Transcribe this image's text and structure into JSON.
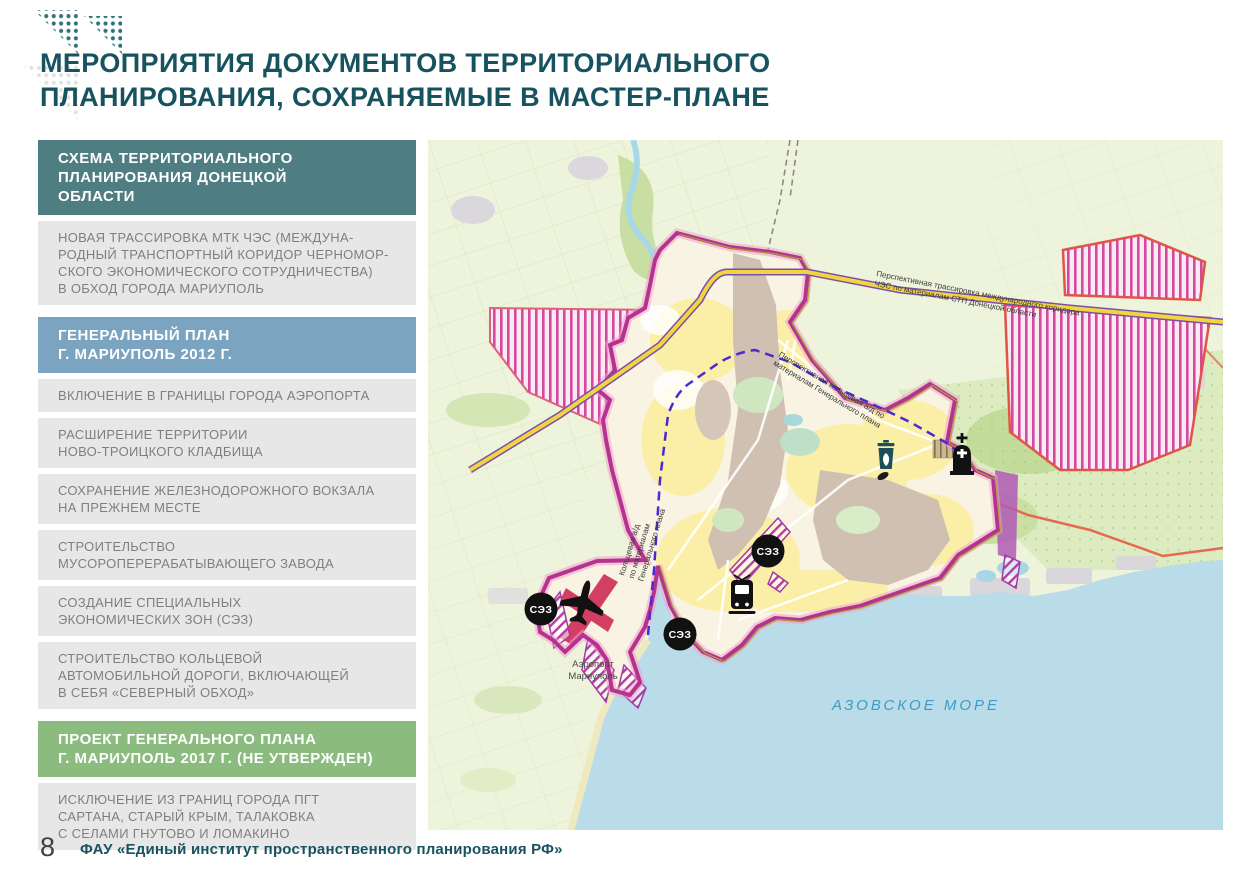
{
  "page": {
    "title": "МЕРОПРИЯТИЯ ДОКУМЕНТОВ ТЕРРИТОРИАЛЬНОГО\nПЛАНИРОВАНИЯ, СОХРАНЯЕМЫЕ В МАСТЕР-ПЛАНЕ"
  },
  "sidebar": {
    "blocks": [
      {
        "type": "header",
        "text": "СХЕМА ТЕРРИТОРИАЛЬНОГО\nПЛАНИРОВАНИЯ ДОНЕЦКОЙ\nОБЛАСТИ"
      },
      {
        "type": "item",
        "text": "НОВАЯ ТРАССИРОВКА МТК ЧЭС (МЕЖДУНА-\nРОДНЫЙ ТРАНСПОРТНЫЙ КОРИДОР ЧЕРНОМОР-\nСКОГО ЭКОНОМИЧЕСКОГО СОТРУДНИЧЕСТВА)\nВ ОБХОД ГОРОДА МАРИУПОЛЬ"
      },
      {
        "type": "header",
        "text": "ГЕНЕРАЛЬНЫЙ ПЛАН\nГ. МАРИУПОЛЬ 2012 Г."
      },
      {
        "type": "item",
        "text": "ВКЛЮЧЕНИЕ В ГРАНИЦЫ ГОРОДА АЭРОПОРТА"
      },
      {
        "type": "item",
        "text": "РАСШИРЕНИЕ ТЕРРИТОРИИ\nНОВО-ТРОИЦКОГО КЛАДБИЩА"
      },
      {
        "type": "item",
        "text": "СОХРАНЕНИЕ ЖЕЛЕЗНОДОРОЖНОГО ВОКЗАЛА\nНА ПРЕЖНЕМ МЕСТЕ"
      },
      {
        "type": "item",
        "text": "СТРОИТЕЛЬСТВО\nМУСОРОПЕРЕРАБАТЫВАЮЩЕГО ЗАВОДА"
      },
      {
        "type": "item",
        "text": "СОЗДАНИЕ СПЕЦИАЛЬНЫХ\nЭКОНОМИЧЕСКИХ ЗОН (СЭЗ)"
      },
      {
        "type": "item",
        "text": "СТРОИТЕЛЬСТВО КОЛЬЦЕВОЙ\nАВТОМОБИЛЬНОЙ ДОРОГИ, ВКЛЮЧАЮЩЕЙ\nВ СЕБЯ «СЕВЕРНЫЙ ОБХОД»"
      },
      {
        "type": "header",
        "text": "ПРОЕКТ ГЕНЕРАЛЬНОГО ПЛАНА\nГ. МАРИУПОЛЬ 2017 Г. (НЕ УТВЕРЖДЕН)"
      },
      {
        "type": "item",
        "text": "ИСКЛЮЧЕНИЕ ИЗ ГРАНИЦ ГОРОДА ПГТ\nСАРТАНА, СТАРЫЙ КРЫМ, ТАЛАКОВКА\nС СЕЛАМИ ГНУТОВО И ЛОМАКИНО"
      }
    ]
  },
  "map": {
    "road_label_line1": "Перспективная трассировка международного коридора",
    "road_label_line2": "ЧЭС по материалам СТП Донецкой области",
    "ring_ne_label_line1": "Перспективная кольцевая а/д по",
    "ring_ne_label_line2": "материалам Генерального плана",
    "ring_w_label_line1": "Кольцевая а/д",
    "ring_w_label_line2": "по материалам",
    "ring_w_label_line3": "Генерального плана",
    "airport_label_line1": "Аэропорт",
    "airport_label_line2": "Мариуполь",
    "sea_label": "АЗОВСКОЕ МОРЕ",
    "sez_badge_label": "СЭЗ",
    "icons": [
      "sez-badge",
      "airplane-icon",
      "tram-icon",
      "church-icon",
      "waste-plant-icon"
    ]
  },
  "footer": {
    "page_number": "8",
    "organization": "ФАУ «Единый институт пространственного планирования РФ»"
  },
  "colors": {
    "title": "#17525F",
    "header_teal": "#4E7E81",
    "header_blue": "#7BA4C0",
    "header_green": "#8CBB80",
    "item_bg": "#E7E7E7",
    "item_text": "#7F7F7F",
    "boundary_magenta": "#B5338F",
    "sea": "#B9DCE8",
    "road_yellow": "#F2D53E",
    "ring_road_purple": "#4A2BD0",
    "hatch_magenta": "#D24A9E",
    "runway_red": "#D23F63",
    "land": "#EEF3DC"
  }
}
